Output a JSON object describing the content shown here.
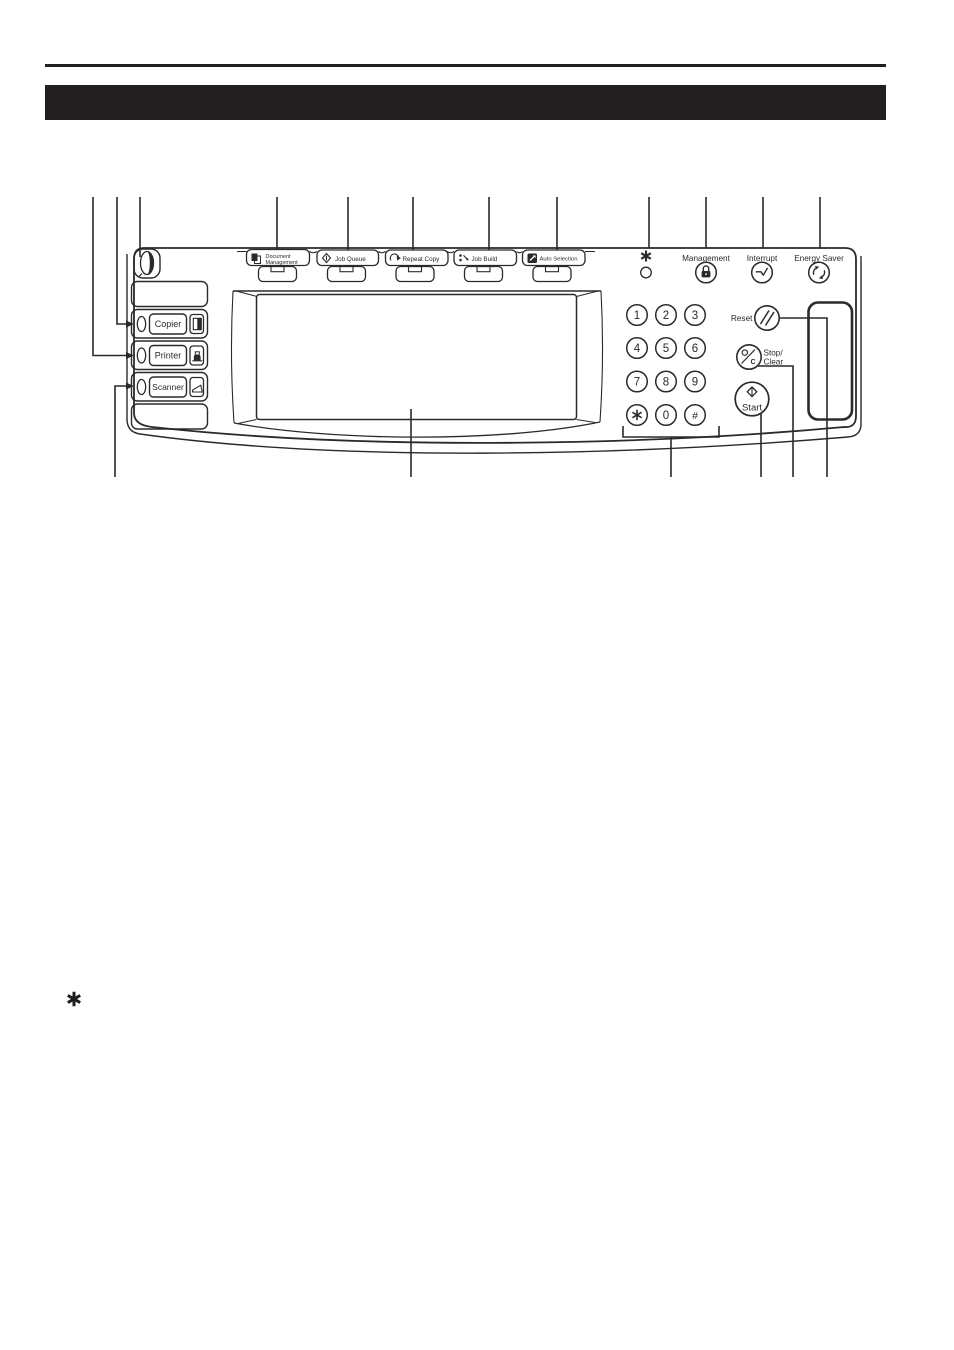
{
  "colors": {
    "ink": "#2a2a2a",
    "bar": "#231f20",
    "paper": "#ffffff"
  },
  "footnote": {
    "symbol": "✱"
  },
  "panel": {
    "mode_keys": [
      {
        "label": "Copier"
      },
      {
        "label": "Printer"
      },
      {
        "label": "Scanner"
      }
    ],
    "function_keys": [
      {
        "label_line1": "Document",
        "label_line2": "Management"
      },
      {
        "label": "Job Queue"
      },
      {
        "label": "Repeat Copy"
      },
      {
        "label": "Job Build"
      },
      {
        "label": "Auto Selection"
      }
    ],
    "utility_keys": {
      "asterisk_symbol": "✱",
      "management_label": "Management",
      "interrupt_label": "Interrupt",
      "energy_saver_label": "Energy Saver"
    },
    "keypad": {
      "digits": [
        "1",
        "2",
        "3",
        "4",
        "5",
        "6",
        "7",
        "8",
        "9",
        "0"
      ],
      "star_symbol": "✱",
      "hash_symbol": "#"
    },
    "control_keys": {
      "reset_label": "Reset",
      "stop_label_line1": "Stop/",
      "stop_label_line2": "Clear",
      "stop_icon_letter": "C",
      "start_label": "Start"
    }
  }
}
